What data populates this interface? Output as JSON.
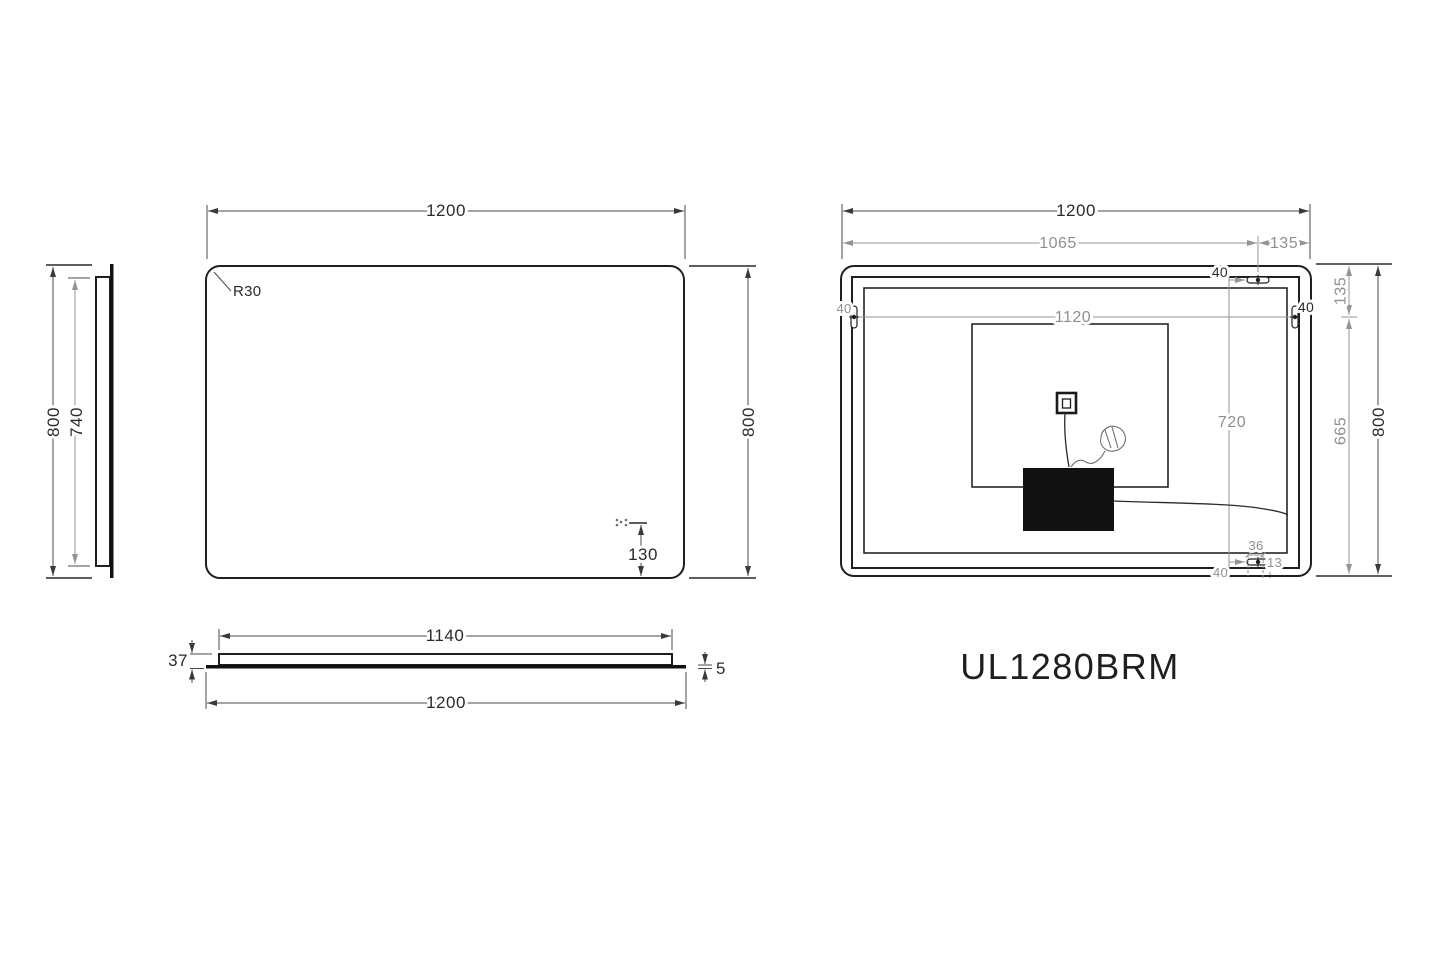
{
  "model_label": "UL1280BRM",
  "side_view": {
    "height_label": "800",
    "panel_height_label": "740"
  },
  "front_view": {
    "width_label": "1200",
    "height_label": "800",
    "corner_radius_label": "R30",
    "sensor_offset_label": "130"
  },
  "bottom_view": {
    "panel_width_label": "1140",
    "overall_width_label": "1200",
    "thickness_label": "37",
    "glass_thickness_label": "5"
  },
  "rear_view": {
    "width_label": "1200",
    "hanger_span_label": "1065",
    "hanger_right_offset_label": "135",
    "hanger_inner_span_label": "1120",
    "hanger_vertical_span_label": "720",
    "top_margin_label": "135",
    "bottom_section_label": "665",
    "height_label": "800",
    "hanger_top_offset_label": "40",
    "hanger_left_offset_label": "40",
    "hanger_right_edge_offset_label": "40",
    "hanger_bottom_offset_label": "40",
    "slot_length_label": "36",
    "slot_side_label": "13"
  }
}
